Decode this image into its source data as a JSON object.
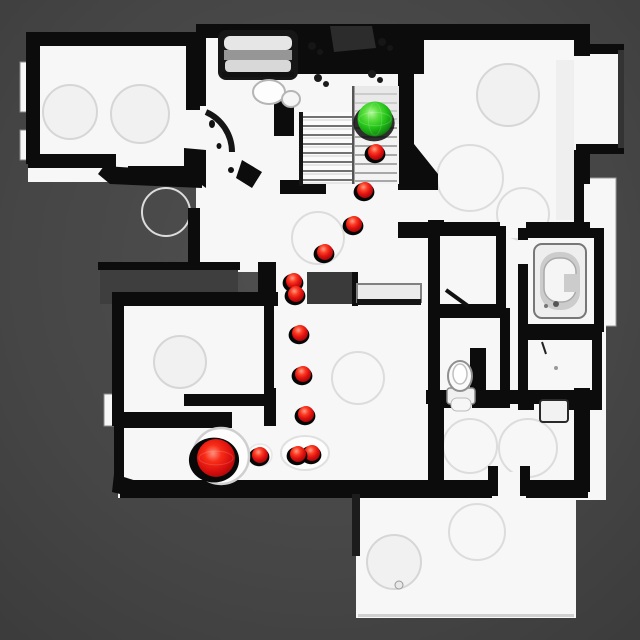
{
  "scene": {
    "description": "Top-down rendered floor plan of a scanned house with a navigation path visualization",
    "background_color": "#474747",
    "floor_color": "#f7f7f7",
    "wall_color": "#0c0c0c",
    "void_color": "#3e3e3e"
  },
  "markers": {
    "start": {
      "name": "start-sphere",
      "color": "#2fc31c",
      "x": 375,
      "y": 119,
      "r": 17.5
    },
    "goal": {
      "name": "goal-sphere",
      "color": "#e01212",
      "x": 216,
      "y": 458,
      "r": 19,
      "halo_r": 28
    },
    "waypoint": {
      "color": "#e01212",
      "r": 8
    },
    "waypoints": [
      {
        "x": 376,
        "y": 152
      },
      {
        "x": 365,
        "y": 190
      },
      {
        "x": 354,
        "y": 224
      },
      {
        "x": 325,
        "y": 252
      },
      {
        "x": 294,
        "y": 281
      },
      {
        "x": 296,
        "y": 294
      },
      {
        "x": 300,
        "y": 333
      },
      {
        "x": 303,
        "y": 374
      },
      {
        "x": 306,
        "y": 414
      },
      {
        "x": 312,
        "y": 453
      },
      {
        "x": 298,
        "y": 454
      },
      {
        "x": 260,
        "y": 455
      }
    ]
  }
}
